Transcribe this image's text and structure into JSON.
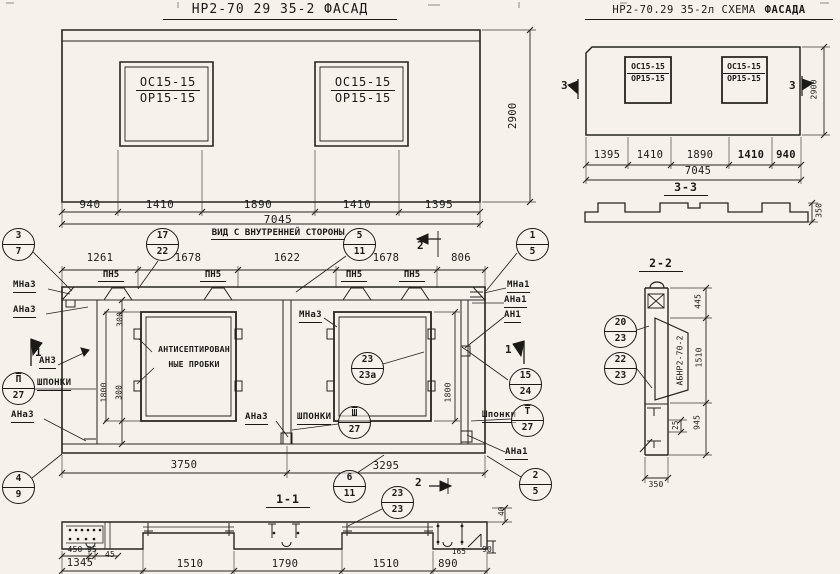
{
  "facade": {
    "title": "НР2-70 29 35-2    ФАСАД",
    "win_top": "ОС15-15",
    "win_bot": "ОР15-15",
    "dims": [
      "940",
      "1410",
      "1890",
      "1410",
      "1395"
    ],
    "total": "7045",
    "height": "2900"
  },
  "schema": {
    "title": "НР2-70.29 35-2л СХЕМА",
    "title_bold": "ФАСАДА",
    "win_top": "ОС15-15",
    "win_bot": "ОР15-15",
    "dims": [
      "1395",
      "1410",
      "1890",
      "1410",
      "940"
    ],
    "total": "7045",
    "height": "2900",
    "marker_left": "3",
    "marker_right": "3"
  },
  "sec33": {
    "title": "3-3",
    "thickness": "350"
  },
  "inner": {
    "title": "ВИД С ВНУТРЕННЕЙ СТОРОНЫ",
    "dims": [
      "1261",
      "1678",
      "1622",
      "1678",
      "806"
    ],
    "pn": [
      "ПН5",
      "ПН5",
      "ПН5",
      "ПН5"
    ],
    "v300_top": "300",
    "v1800_left": "1800",
    "v300_bot": "300",
    "v1800_right": "1800",
    "d3750": "3750",
    "d3295": "3295",
    "labels": {
      "mna3_left": "МНа3",
      "ana3_left": "АНа3",
      "an3": "АН3",
      "shponki_left": "ШПОНКИ",
      "ana3_low": "АНа3",
      "mna3_mid": "МНа3",
      "ana3_mid": "АНа3",
      "shponki_mid": "ШПОНКИ",
      "mna1": "МНа1",
      "ana1": "АНа1",
      "an1": "АН1",
      "shponki_right": "Шпонки",
      "ana1_low": "АНа1",
      "note1": "АНТИСЕПТИРОВАН",
      "note2": "НЫЕ ПРОБКИ"
    },
    "markers": {
      "m1_left": "1",
      "m1_right": "1",
      "m2_top": "2",
      "m2_bot": "2"
    },
    "callouts": {
      "c37": {
        "top": "3",
        "bottom": "7"
      },
      "c1722": {
        "top": "17",
        "bottom": "22"
      },
      "c511": {
        "top": "5",
        "bottom": "11"
      },
      "c15": {
        "top": "1",
        "bottom": "5"
      },
      "c2323a": {
        "top": "23",
        "bottom": "23а"
      },
      "c1524": {
        "top": "15",
        "bottom": "24"
      },
      "cII27": {
        "top": "П",
        "bottom": "27"
      },
      "cIII27": {
        "top": "Ш",
        "bottom": "27"
      },
      "cI27": {
        "top": "Т",
        "bottom": "27"
      },
      "c25": {
        "top": "2",
        "bottom": "5"
      },
      "c49": {
        "top": "4",
        "bottom": "9"
      },
      "c611": {
        "top": "6",
        "bottom": "11"
      }
    }
  },
  "sec22": {
    "title": "2-2",
    "part_label": "АБНР2-70-2",
    "d445": "445",
    "d1510": "1510",
    "d945": "945",
    "d25": "25",
    "d350": "350",
    "callouts": {
      "c2023": {
        "top": "20",
        "bottom": "23"
      },
      "c2223": {
        "top": "22",
        "bottom": "23"
      }
    }
  },
  "sec11": {
    "title": "1-1",
    "dims": [
      "1345",
      "1510",
      "1790",
      "1510",
      "890"
    ],
    "d450": "450",
    "d95": "95",
    "d45": "45",
    "d165": "165",
    "d90": "90",
    "d40": "40",
    "callout": {
      "top": "23",
      "bottom": "23"
    }
  }
}
